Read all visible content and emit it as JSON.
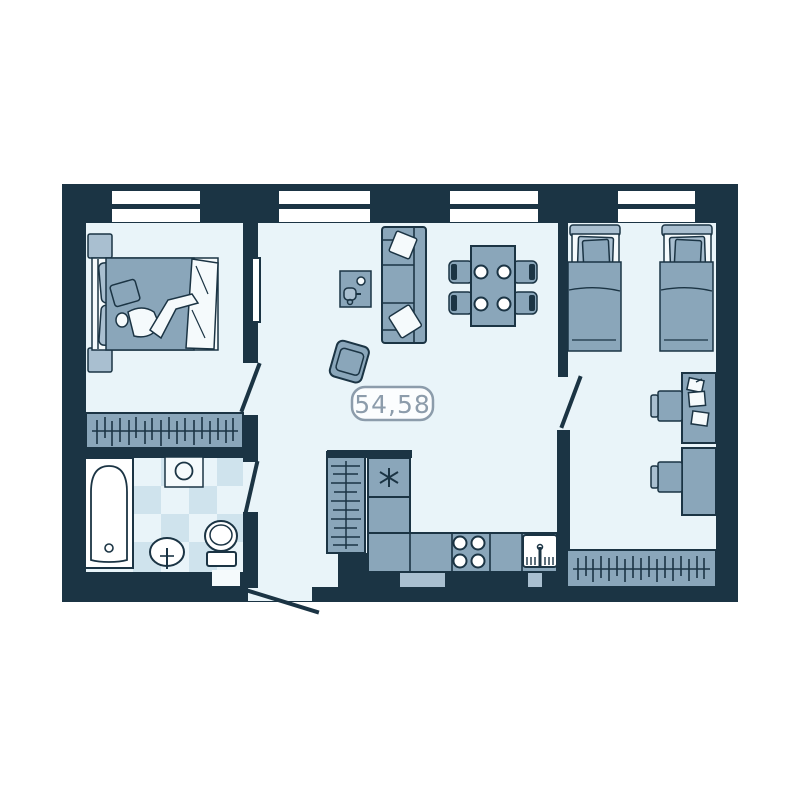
{
  "floor_plan": {
    "area_label": "54,58",
    "palette": {
      "wall": "#1b3444",
      "floor": "#e9f4f9",
      "furniture": "#8aa6ba",
      "furniture_light": "#a9bfd0",
      "tile": "#cfe3ed",
      "fixture_white": "#ffffff",
      "label_accent": "#8c9cab",
      "page_background": "#ffffff"
    },
    "window_count": 4,
    "door_count": 4,
    "rooms": [
      {
        "name": "bedroom",
        "furniture": [
          "double-bed",
          "nightstand",
          "nightstand",
          "wardrobe",
          "tv"
        ]
      },
      {
        "name": "living-room",
        "furniture": [
          "sofa",
          "coffee-table",
          "armchair",
          "dining-table",
          "chair",
          "chair",
          "chair",
          "chair"
        ]
      },
      {
        "name": "kids-bedroom",
        "furniture": [
          "single-bed",
          "single-bed",
          "desk",
          "desk",
          "desk-chair",
          "desk-chair",
          "wardrobe"
        ]
      },
      {
        "name": "bathroom",
        "furniture": [
          "bathtub",
          "washing-machine",
          "sink",
          "toilet"
        ]
      },
      {
        "name": "kitchen",
        "furniture": [
          "closet-shelves",
          "fridge",
          "counter",
          "stove",
          "kitchen-sink"
        ]
      }
    ]
  }
}
